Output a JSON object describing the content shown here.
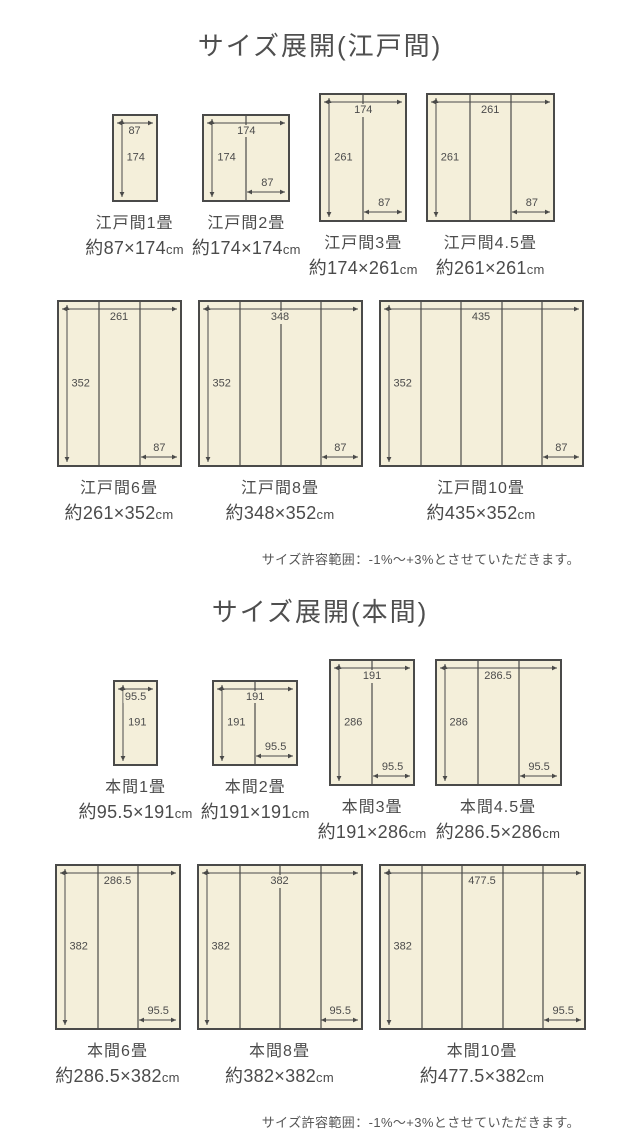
{
  "colors": {
    "mat_fill": "#f4efda",
    "line": "#4a4a49",
    "text": "#4b4b4b"
  },
  "sections": [
    {
      "title": "サイズ展開(江戸間)",
      "note": "サイズ許容範囲：-1%〜+3%とさせていただきます。",
      "rows": [
        [
          {
            "name": "江戸間1畳",
            "size": "約87×174cm",
            "top": "87",
            "left": "174",
            "bottom": null,
            "cols": 1,
            "w_cm": 87,
            "h_cm": 174
          },
          {
            "name": "江戸間2畳",
            "size": "約174×174cm",
            "top": "174",
            "left": "174",
            "bottom": "87",
            "cols": 2,
            "w_cm": 174,
            "h_cm": 174
          },
          {
            "name": "江戸間3畳",
            "size": "約174×261cm",
            "top": "174",
            "left": "261",
            "bottom": "87",
            "cols": 2,
            "w_cm": 174,
            "h_cm": 261
          },
          {
            "name": "江戸間4.5畳",
            "size": "約261×261cm",
            "top": "261",
            "left": "261",
            "bottom": "87",
            "cols": 3,
            "w_cm": 261,
            "h_cm": 261
          }
        ],
        [
          {
            "name": "江戸間6畳",
            "size": "約261×352cm",
            "top": "261",
            "left": "352",
            "bottom": "87",
            "cols": 3,
            "w_cm": 261,
            "h_cm": 352
          },
          {
            "name": "江戸間8畳",
            "size": "約348×352cm",
            "top": "348",
            "left": "352",
            "bottom": "87",
            "cols": 4,
            "w_cm": 348,
            "h_cm": 352
          },
          {
            "name": "江戸間10畳",
            "size": "約435×352cm",
            "top": "435",
            "left": "352",
            "bottom": "87",
            "cols": 5,
            "w_cm": 435,
            "h_cm": 352
          }
        ]
      ]
    },
    {
      "title": "サイズ展開(本間)",
      "note": "サイズ許容範囲：-1%〜+3%とさせていただきます。",
      "rows": [
        [
          {
            "name": "本間1畳",
            "size": "約95.5×191cm",
            "top": "95.5",
            "left": "191",
            "bottom": null,
            "cols": 1,
            "w_cm": 95.5,
            "h_cm": 191
          },
          {
            "name": "本間2畳",
            "size": "約191×191cm",
            "top": "191",
            "left": "191",
            "bottom": "95.5",
            "cols": 2,
            "w_cm": 191,
            "h_cm": 191
          },
          {
            "name": "本間3畳",
            "size": "約191×286cm",
            "top": "191",
            "left": "286",
            "bottom": "95.5",
            "cols": 2,
            "w_cm": 191,
            "h_cm": 286
          },
          {
            "name": "本間4.5畳",
            "size": "約286.5×286cm",
            "top": "286.5",
            "left": "286",
            "bottom": "95.5",
            "cols": 3,
            "w_cm": 286.5,
            "h_cm": 286
          }
        ],
        [
          {
            "name": "本間6畳",
            "size": "約286.5×382cm",
            "top": "286.5",
            "left": "382",
            "bottom": "95.5",
            "cols": 3,
            "w_cm": 286.5,
            "h_cm": 382
          },
          {
            "name": "本間8畳",
            "size": "約382×382cm",
            "top": "382",
            "left": "382",
            "bottom": "95.5",
            "cols": 4,
            "w_cm": 382,
            "h_cm": 382
          },
          {
            "name": "本間10畳",
            "size": "約477.5×382cm",
            "top": "477.5",
            "left": "382",
            "bottom": "95.5",
            "cols": 5,
            "w_cm": 477.5,
            "h_cm": 382
          }
        ]
      ]
    }
  ]
}
